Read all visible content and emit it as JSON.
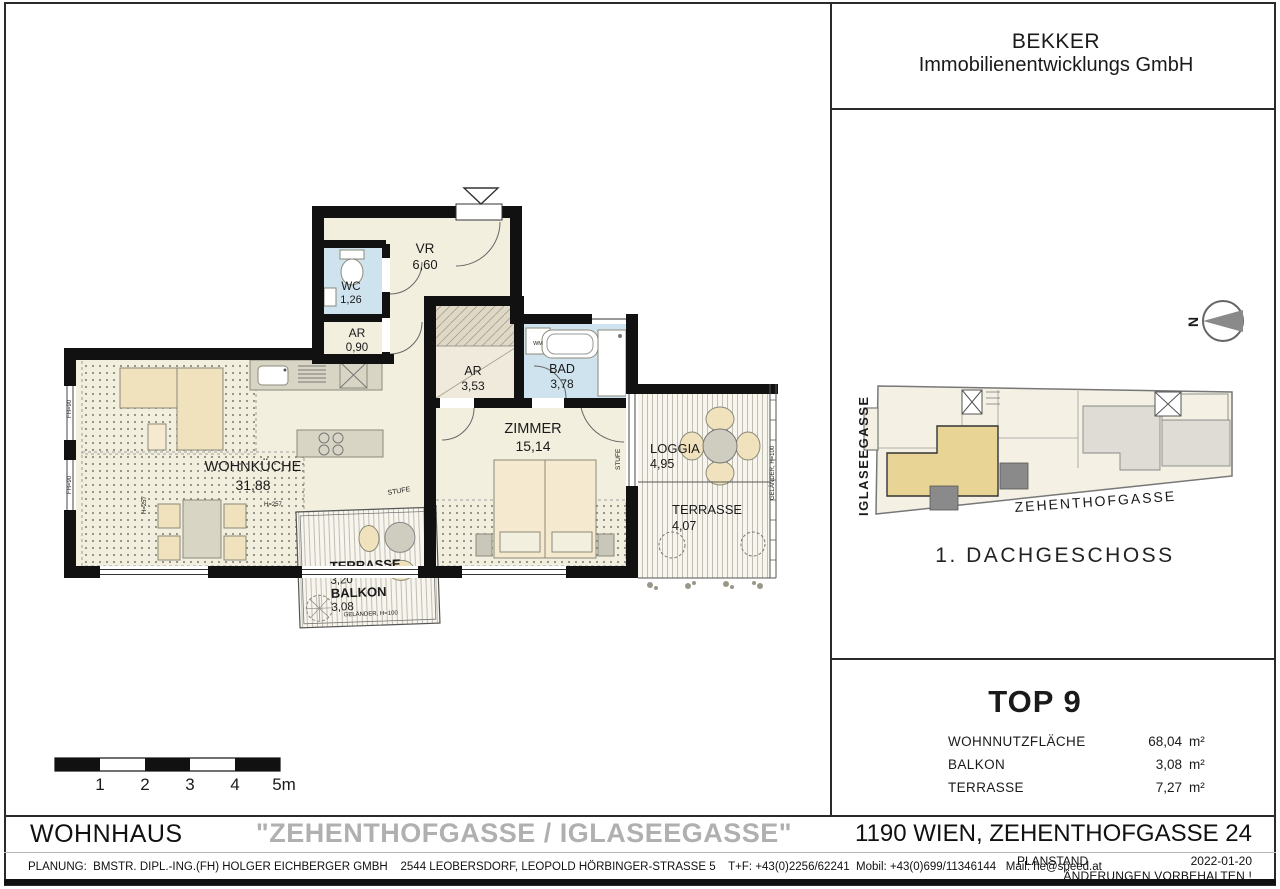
{
  "company": {
    "line1": "BEKKER",
    "line2": "Immobilienentwicklungs GmbH"
  },
  "floorplan": {
    "rooms": [
      {
        "name": "VR",
        "area": "6,60"
      },
      {
        "name": "WC",
        "area": "1,26"
      },
      {
        "name": "AR",
        "area": "0,90"
      },
      {
        "name": "AR",
        "area": "3,53"
      },
      {
        "name": "BAD",
        "area": "3,78"
      },
      {
        "name": "ZIMMER",
        "area": "15,14"
      },
      {
        "name": "WOHNKÜCHE",
        "area": "31,88"
      },
      {
        "name": "LOGGIA",
        "area": "4,95"
      },
      {
        "name": "TERRASSE",
        "area": "4,07"
      },
      {
        "name": "TERRASSE",
        "area": "3,20"
      },
      {
        "name": "BALKON",
        "area": "3,08"
      }
    ],
    "labels": {
      "stufe": "STUFE",
      "gelaender": "GELÄNDER, H=100",
      "wm": "WM",
      "h257": "H=257",
      "fh90": "FH=90"
    },
    "scale_ticks": [
      "1",
      "2",
      "3",
      "4",
      "5m"
    ],
    "north": "N"
  },
  "siteplan": {
    "street_left": "IGLASEEGASSE",
    "street_bottom": "ZEHENTHOFGASSE",
    "level": "1. DACHGESCHOSS"
  },
  "unit": {
    "title": "TOP 9",
    "rows": [
      {
        "label": "WOHNNUTZFLÄCHE",
        "value": "68,04",
        "unit": "m²"
      },
      {
        "label": "BALKON",
        "value": "3,08",
        "unit": "m²"
      },
      {
        "label": "TERRASSE",
        "value": "7,27",
        "unit": "m²"
      }
    ]
  },
  "title_bar": {
    "left": "WOHNHAUS",
    "center": "\"ZEHENTHOFGASSE / IGLASEEGASSE\"",
    "right": "1190 WIEN, ZEHENTHOFGASSE 24"
  },
  "footer": {
    "planung": "PLANUNG:  BMSTR. DIPL.-ING.(FH) HOLGER EICHBERGER GMBH    2544 LEOBERSDORF, LEOPOLD HÖRBINGER-STRASSE 5    T+F: +43(0)2256/62241  Mobil: +43(0)699/11346144   Mail: he@speed.at",
    "planstand_label": "PLANSTAND",
    "planstand_value": "2022-01-20",
    "note": "ÄNDERUNGEN VORBEHALTEN !"
  },
  "colors": {
    "unit_highlight": "#E8D494",
    "wet_room": "#CFE3EE",
    "room_cream": "#F3EFDF",
    "title_gray": "#B0B0B0"
  }
}
